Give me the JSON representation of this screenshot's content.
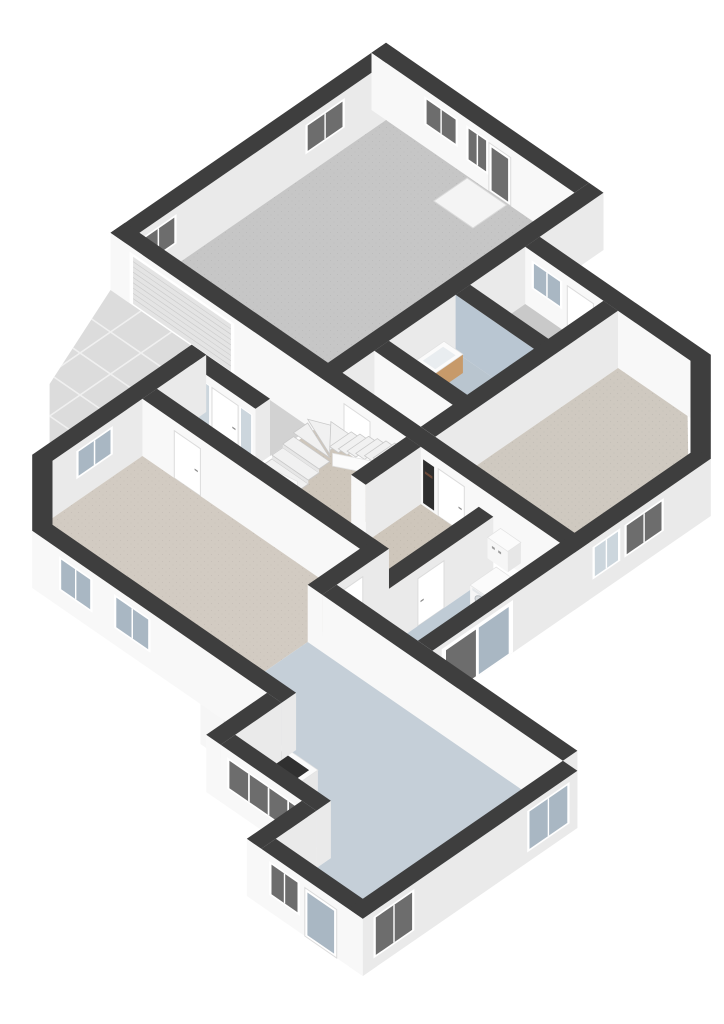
{
  "scene": {
    "type": "3d-floorplan-render",
    "view": "isometric-ground-floor",
    "background": "#ffffff"
  },
  "colors": {
    "wall_top": "#3e3e3e",
    "wall_sw": "#f8f8f8",
    "wall_se": "#eaeaea",
    "wall_diag": "#f1f1f1",
    "frame": "#ffffff",
    "frame_edge": "#dcdcdc",
    "glass_dark": "#6d6d6d",
    "glass_blue": "#a9b7c3",
    "glass_pale": "#ccd6dd",
    "tile_wall": "#b9c6d2",
    "wood": "#c79a6a",
    "appliance": "#f6f6f6",
    "appliance_side": "#e7e7e7",
    "appliance_top": "#fbfbfb",
    "dark": "#2e2e2e",
    "handle": "#8a8a8a",
    "step": "#f1f1f1",
    "step_riser": "#e6e6e6",
    "step_edge": "#c9c9c9",
    "rail": "#fbfbfb",
    "driveway": "#dcdcdc",
    "tile_line": "#f0f0f0",
    "porch": "#d2d2d2",
    "mat": "#f4f4f4",
    "garage_door": "#e4e4e4",
    "garage_door_slat": "#cccccc",
    "counter_inset": "#3b3b3b",
    "cooktop": "#303030"
  },
  "rooms": [
    {
      "name": "garage",
      "fill": "#c6c6c6"
    },
    {
      "name": "upper-hall",
      "fill": "#c9c9c9"
    },
    {
      "name": "toilet",
      "fill": "#b9c5cf"
    },
    {
      "name": "closet",
      "fill": "#c9c9c9"
    },
    {
      "name": "bedroom",
      "fill": "#cfc9c0"
    },
    {
      "name": "hall",
      "fill": "#cec6bb"
    },
    {
      "name": "living-room",
      "fill": "#d2cbc2"
    },
    {
      "name": "utility",
      "fill": "#bfcbd5"
    },
    {
      "name": "kitchen",
      "fill": "#c5cfd8"
    }
  ],
  "features": [
    "garage-door",
    "front-door",
    "winder-stairs",
    "washing-machine",
    "boiler",
    "kitchen-counter",
    "toilet-sink",
    "sliding-door",
    "driveway-tiles",
    "meter-cupboard",
    "doormat",
    "windows"
  ]
}
